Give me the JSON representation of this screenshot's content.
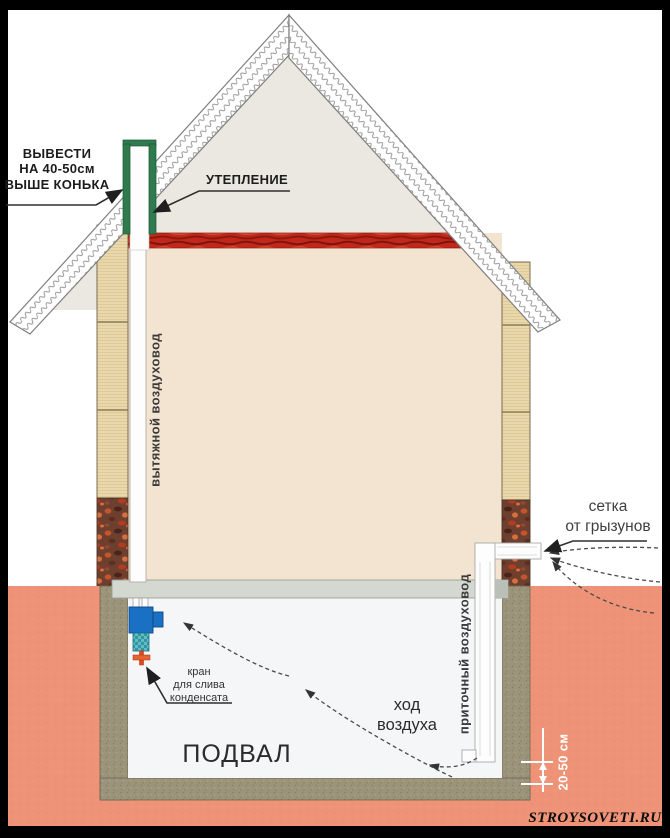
{
  "labels": {
    "ridge_note": {
      "lines": [
        "ВЫВЕСТИ",
        "НА 40-50см",
        "ВЫШЕ КОНЬКА"
      ]
    },
    "insulation": "УТЕПЛЕНИЕ",
    "exhaust_duct": "вытяжной воздуховод",
    "rodent_screen": {
      "lines": [
        "сетка",
        "от грызунов"
      ]
    },
    "supply_duct": "приточный воздуховод",
    "condensate_valve": {
      "lines": [
        "кран",
        "для слива",
        "конденсата"
      ]
    },
    "air_flow": {
      "lines": [
        "ход",
        "воздуха"
      ]
    },
    "basement": "ПОДВАЛ",
    "clearance": "20-50 см"
  },
  "watermark": "STROYSOVETI.RU",
  "colors": {
    "frame_black": "#000000",
    "background_white": "#ffffff",
    "gable_gray": "#eae8e0",
    "interior_beige": "#f3e4d1",
    "attic_insulation_red": "#c1271a",
    "wall_block_beige": "#e9d8ac",
    "wall_rubble_brown": "#6e3f2e",
    "ground_salmon": "#ee9377",
    "basement_wall_olive": "#9b947b",
    "ceiling_slab_gray": "#d3d8d1",
    "duct_white": "#fdfdfd",
    "duct_insulation_green": "#2f7b4f",
    "condensate_trap_blue": "#1a70c2",
    "valve_body_teal": "#2d98a4",
    "drain_valve_red": "#e2491f",
    "dimension_white": "#ffffff",
    "label_text_dark": "#1c1c1c"
  }
}
